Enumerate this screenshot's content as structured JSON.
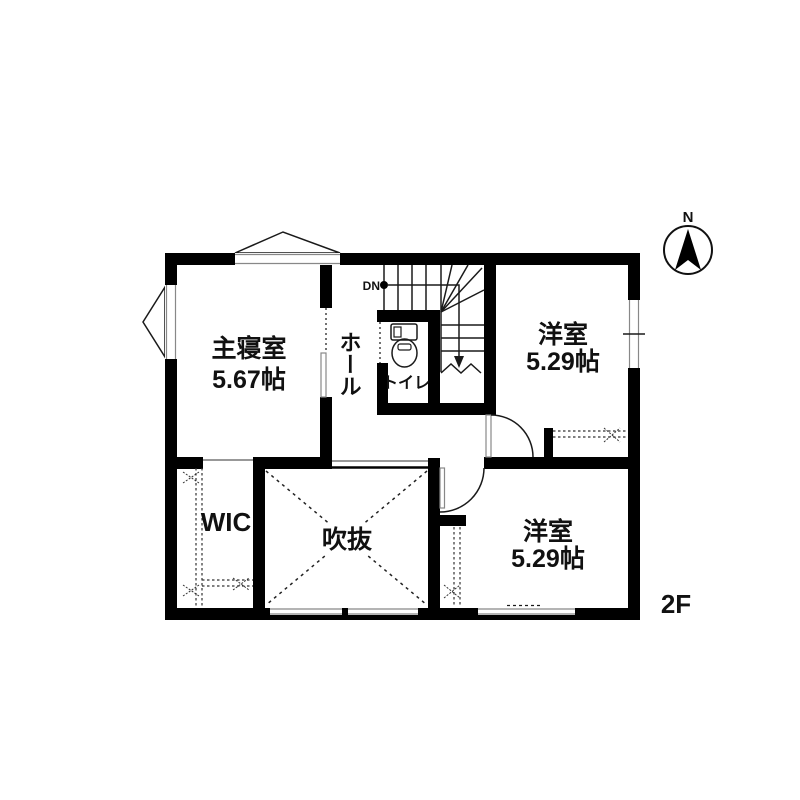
{
  "floor": {
    "label": "2F"
  },
  "compass": {
    "label": "N"
  },
  "rooms": [
    {
      "id": "master-bedroom",
      "name": "主寝室",
      "size": "5.67帖"
    },
    {
      "id": "hall",
      "name": "ホール"
    },
    {
      "id": "toilet",
      "name": "トイレ"
    },
    {
      "id": "western-room-north",
      "name": "洋室",
      "size": "5.29帖"
    },
    {
      "id": "western-room-south",
      "name": "洋室",
      "size": "5.29帖"
    },
    {
      "id": "wic",
      "name": "WIC"
    },
    {
      "id": "void",
      "name": "吹抜"
    }
  ],
  "stairs": {
    "direction_label": "DN"
  },
  "colors": {
    "wall": "#000000",
    "background": "#ffffff",
    "line": "#1a1a1a"
  }
}
